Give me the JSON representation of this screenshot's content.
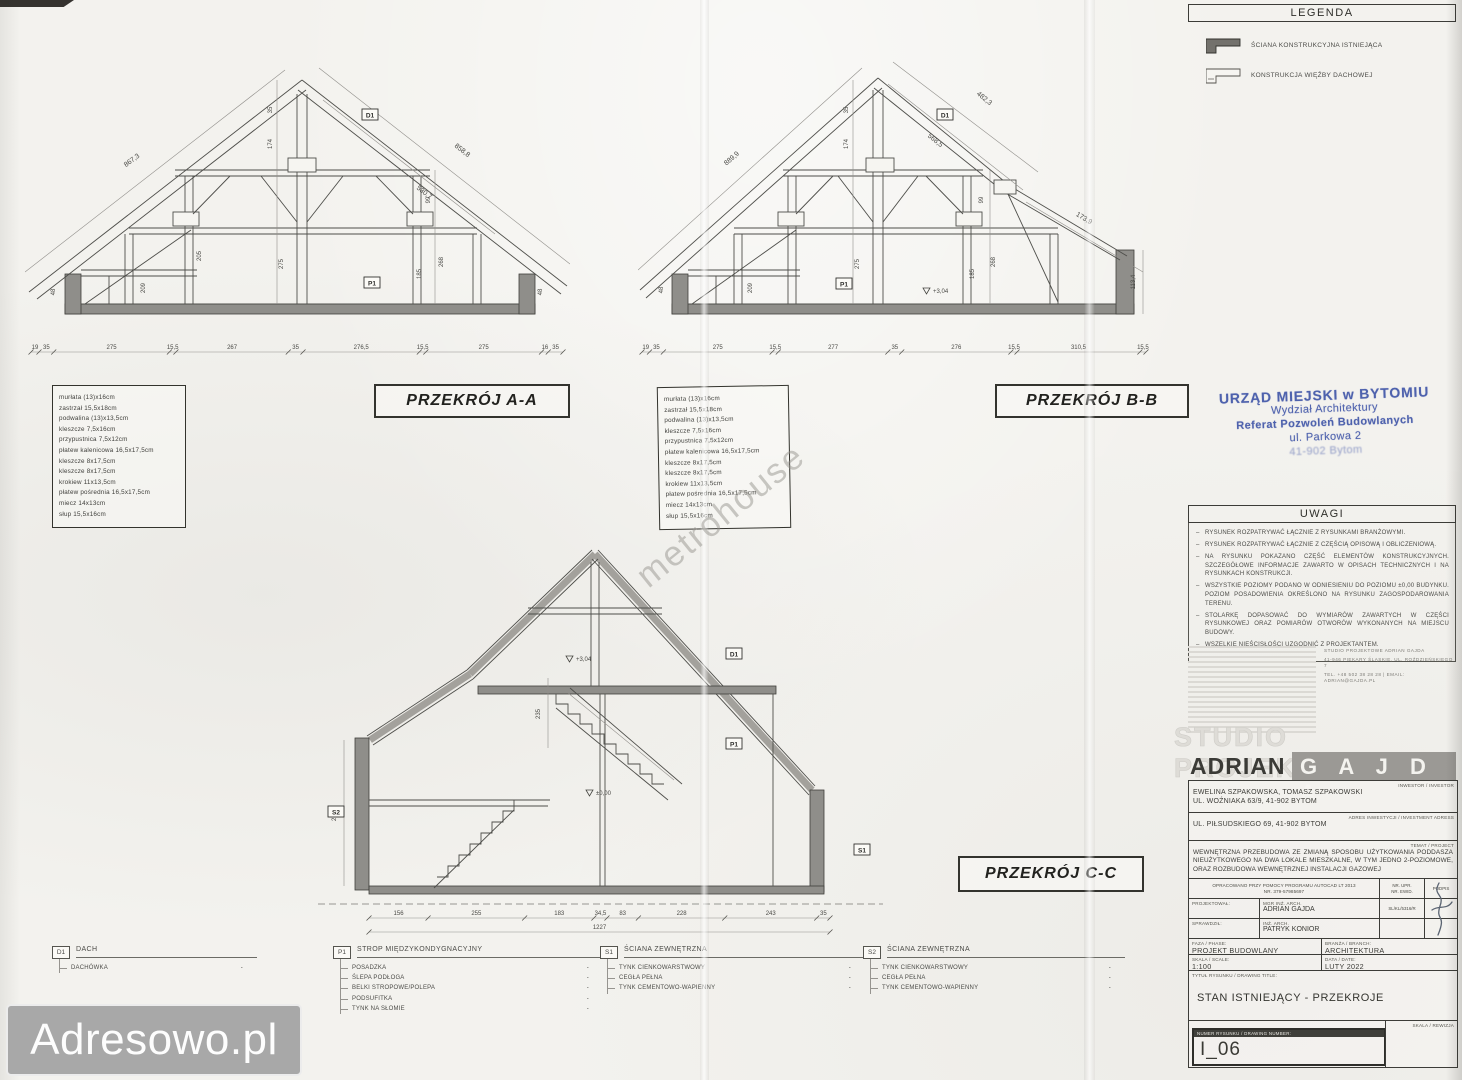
{
  "watermarks": {
    "adresowo": "Adresowo.pl",
    "metrohouse": "metrohouse"
  },
  "legend": {
    "title": "LEGENDA",
    "items": [
      {
        "label": "ŚCIANA KONSTRUKCYJNA ISTNIEJĄCA",
        "swatch": "existing-structural-wall"
      },
      {
        "label": "KONSTRUKCJA WIĘŹBY DACHOWEJ",
        "swatch": "roof-truss-structure"
      }
    ]
  },
  "stamp": {
    "lines": [
      "URZĄD MIEJSKI w BYTOMIU",
      "Wydział Architektury",
      "Referat Pozwoleń Budowlanych",
      "ul. Parkowa 2",
      "41-902 Bytom"
    ]
  },
  "uwagi": {
    "title": "UWAGI",
    "notes": [
      "RYSUNEK ROZPATRYWAĆ ŁĄCZNIE Z RYSUNKAMI BRANŻOWYMI.",
      "RYSUNEK ROZPATRYWAĆ ŁĄCZNIE Z CZĘŚCIĄ OPISOWĄ I OBLICZENIOWĄ.",
      "NA RYSUNKU POKAZANO CZĘŚĆ ELEMENTÓW KONSTRUKCYJNYCH. SZCZEGÓŁOWE INFORMACJE ZAWARTO W OPISACH TECHNICZNYCH I NA RYSUNKACH KONSTRUKCJI.",
      "WSZYSTKIE POZIOMY PODANO W ODNIESIENIU DO POZIOMU ±0,00 BUDYNKU. POZIOM POSADOWIENIA OKREŚLONO NA RYSUNKU ZAGOSPODAROWANIA TERENU.",
      "STOLARKĘ DOPASOWAĆ DO WYMIARÓW ZAWARTYCH W CZĘŚCI RYSUNKOWEJ ORAZ POMIARÓW OTWORÓW WYKONANYCH NA MIEJSCU BUDOWY.",
      "WSZELKIE NIEŚCISŁOŚCI UZGODNIĆ Z PROJEKTANTEM."
    ]
  },
  "studio": {
    "small_lines": [
      "STUDIO PROJEKTOWE ADRIAN GAJDA",
      "41-946 PIEKARY ŚLĄSKIE, UL. ROŹDZIEŃSKIEGO 7",
      "TEL. +48 502 38 28 28 | EMAIL: ADRIAN@GAJDA.PL"
    ],
    "ghost_title": "STUDIO PROJEKTOWE",
    "name_left": "ADRIAN",
    "name_right": "G A J D A"
  },
  "titleblock": {
    "investor_label": "INWESTOR / INVESTOR",
    "investor_line1": "EWELINA SZPAKOWSKA, TOMASZ SZPAKOWSKI",
    "investor_line2": "UL. WOŹNIAKA 63/9, 41-902 BYTOM",
    "address_label": "ADRES INWESTYCJI / INVESTMENT ADRESS",
    "address": "UL. PIŁSUDSKIEGO 69, 41-902 BYTOM",
    "subject_label": "TEMAT / PROJECT",
    "subject": "WEWNĘTRZNA PRZEBUDOWA ZE ZMIANĄ SPOSOBU UŻYTKOWANIA PODDASZA NIEUŻYTKOWEGO NA DWA LOKALE MIESZKALNE, W TYM JEDNO 2-POZIOMOWE, ORAZ ROZBUDOWA WEWNĘTRZNEJ INSTALACJI GAZOWEJ",
    "software_line1": "OPRACOWANO PRZY POMOCY PROGRAMU AUTOCAD LT 2013",
    "software_line2": "NR. 379-57985697",
    "upr_label1": "NR. UPR.",
    "upr_label2": "NR. EWID.",
    "podpis_label": "PODPIS",
    "designed_label": "PROJEKTOWAŁ:",
    "designed_title": "MGR INŻ. ARCH.",
    "designed_name": "ADRIAN GAJDA",
    "designed_upr": "SL/KL/5316/R",
    "checked_label": "SPRAWDZIŁ:",
    "checked_title": "INŻ. ARCH.",
    "checked_name": "PATRYK KONIOR",
    "phase_label": "FAZA / PHASE:",
    "phase": "PROJEKT BUDOWLANY",
    "branch_label": "BRANŻA / BRANCH:",
    "branch": "ARCHITEKTURA",
    "scale_label": "SKALA / SCALE:",
    "scale": "1:100",
    "date_label": "DATA / DATE:",
    "date": "LUTY 2022",
    "title_label": "TYTUŁ RYSUNKU / DRAWING TITLE:",
    "drawing_title": "STAN ISTNIEJĄCY - PRZEKROJE",
    "number_label": "NUMER RYSUNKU / DRAWING NUMBER:",
    "number": "I_06",
    "revision_label": "SKALA / REWIZJA"
  },
  "sections": {
    "aa": {
      "label": "PRZEKRÓJ A-A",
      "materials": [
        "murłata (13)x16cm",
        "zastrzał 15,5x18cm",
        "podwalina (13)x13,5cm",
        "kleszcze 7,5x16cm",
        "przypustnica 7,5x12cm",
        "płatew kalenicowa 16,5x17,5cm",
        "kleszcze 8x17,5cm",
        "kleszcze 8x17,5cm",
        "krokiew 11x13,5cm",
        "płatew pośrednia 16,5x17,5cm",
        "miecz 14x13cm",
        "słup 15,5x16cm"
      ],
      "markers": [
        "D1",
        "P1"
      ],
      "slope_dims": [
        "867,3",
        "858,8",
        "530,7"
      ],
      "v_dims": [
        "35",
        "174",
        "275",
        "99",
        "268",
        "185",
        "209",
        "205",
        "48",
        "48"
      ],
      "bottom_dims": [
        "19",
        "35",
        "275",
        "15,5",
        "267",
        "35",
        "276,5",
        "15,5",
        "275",
        "16",
        "35"
      ]
    },
    "bb": {
      "label": "PRZEKRÓJ B-B",
      "materials": [
        "murłata (13)x16cm",
        "zastrzał 15,5x18cm",
        "podwalina (13)x13,5cm",
        "kleszcze 7,5x16cm",
        "przypustnica 7,5x12cm",
        "płatew kalenicowa 16,5x17,5cm",
        "kleszcze 8x17,5cm",
        "kleszcze 8x17,5cm",
        "krokiew 11x13,5cm",
        "płatew pośrednia 16,5x17,5cm",
        "miecz 14x13cm",
        "słup 15,5x16cm"
      ],
      "markers": [
        "D1",
        "P1"
      ],
      "slope_dims": [
        "889,9",
        "482,3",
        "568,5",
        "173,9"
      ],
      "v_dims": [
        "35",
        "174",
        "275",
        "99",
        "268",
        "185",
        "209",
        "113,4",
        "48"
      ],
      "levels": [
        "+3,04"
      ],
      "bottom_dims": [
        "19",
        "35",
        "275",
        "15,5",
        "277",
        "35",
        "276",
        "15,5",
        "310,5",
        "15,5"
      ]
    },
    "cc": {
      "label": "PRZEKRÓJ C-C",
      "markers": [
        "S2",
        "S1",
        "D1",
        "P1"
      ],
      "v_dims": [
        "270",
        "235"
      ],
      "levels": [
        "+3,04",
        "±0,00"
      ],
      "bottom_dims": [
        "156",
        "255",
        "183",
        "34,5",
        "83",
        "228",
        "243",
        "35"
      ],
      "total_dim": "1227"
    }
  },
  "bottom_legend": {
    "dash": "-",
    "d1": {
      "code": "D1",
      "title": "DACH",
      "items": [
        "DACHÓWKA"
      ]
    },
    "p1": {
      "code": "P1",
      "title": "STROP MIĘDZYKONDYGNACYJNY",
      "items": [
        "POSADZKA",
        "ŚLEPA PODŁOGA",
        "BELKI STROPOWE/POLEPA",
        "PODSUFITKA",
        "TYNK NA SŁOMIE"
      ]
    },
    "s1": {
      "code": "S1",
      "title": "ŚCIANA ZEWNĘTRZNA",
      "items": [
        "TYNK CIENKOWARSTWOWY",
        "CEGŁA PEŁNA",
        "TYNK CEMENTOWO-WAPIENNY"
      ]
    },
    "s2": {
      "code": "S2",
      "title": "ŚCIANA ZEWNĘTRZNA",
      "items": [
        "TYNK CIENKOWARSTWOWY",
        "CEGŁA PEŁNA",
        "TYNK CEMENTOWO-WAPIENNY"
      ]
    }
  }
}
